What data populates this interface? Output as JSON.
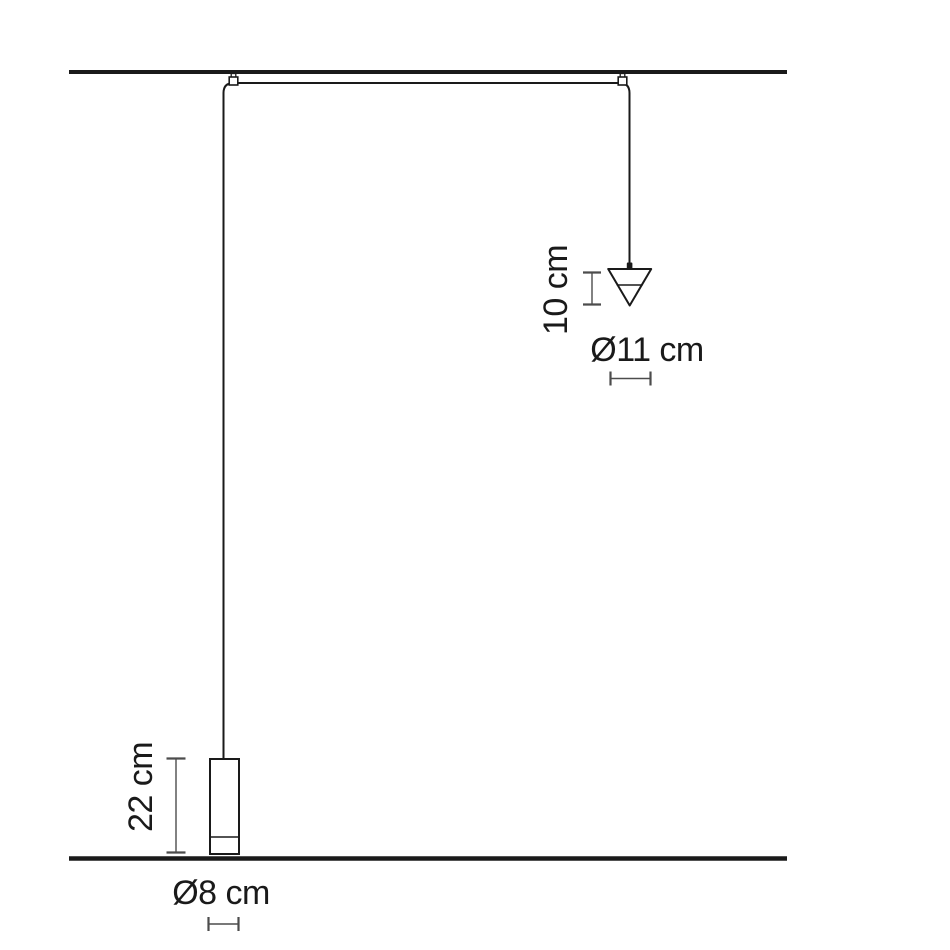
{
  "colors": {
    "ink": "#1a1a1a",
    "dimension_line": "#4c4c4c",
    "background": "#ffffff"
  },
  "measurements": {
    "cone_lamp": {
      "height_label": "10 cm",
      "diameter_label": "Ø11 cm"
    },
    "cylinder_lamp": {
      "height_label": "22 cm",
      "diameter_label": "Ø8 cm"
    }
  }
}
